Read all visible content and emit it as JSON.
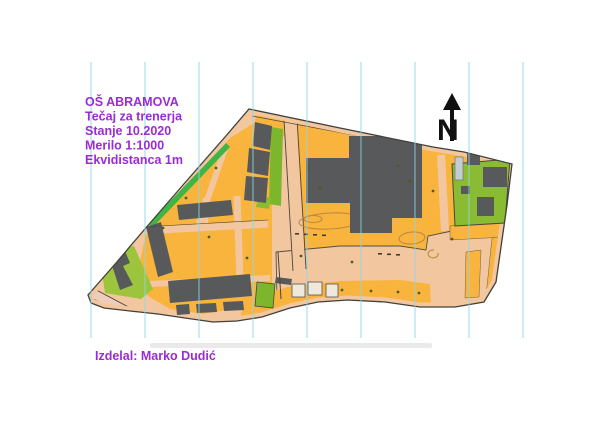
{
  "sheet": {
    "background": "#ffffff"
  },
  "title_block": {
    "color": "#9b2bd3",
    "lines": [
      "OŠ ABRAMOVA",
      "Tečaj za trenerja",
      "Stanje 10.2020",
      "Merilo 1:1000",
      "Ekvidistanca 1m"
    ]
  },
  "credit": {
    "text": "Izdelal: Marko Dudić"
  },
  "north_arrow": {
    "label": "N"
  },
  "map_legend": {
    "type": "orienteering sprint map",
    "colors": {
      "paved_area": "#f2c7a0",
      "rough_open_orange": "#f9b43e",
      "building_gray": "#57595b",
      "vegetation_green": "#8abc33",
      "bright_green_strip": "#3eb546",
      "yellow_green_area": "#9cc43c",
      "canopy_light": "#efe9dd",
      "north_line_cyan": "#8fd5e5",
      "contour_brown": "#bb8a42",
      "road_pink": "#eecdbb",
      "outline_dark": "#41403a"
    }
  }
}
